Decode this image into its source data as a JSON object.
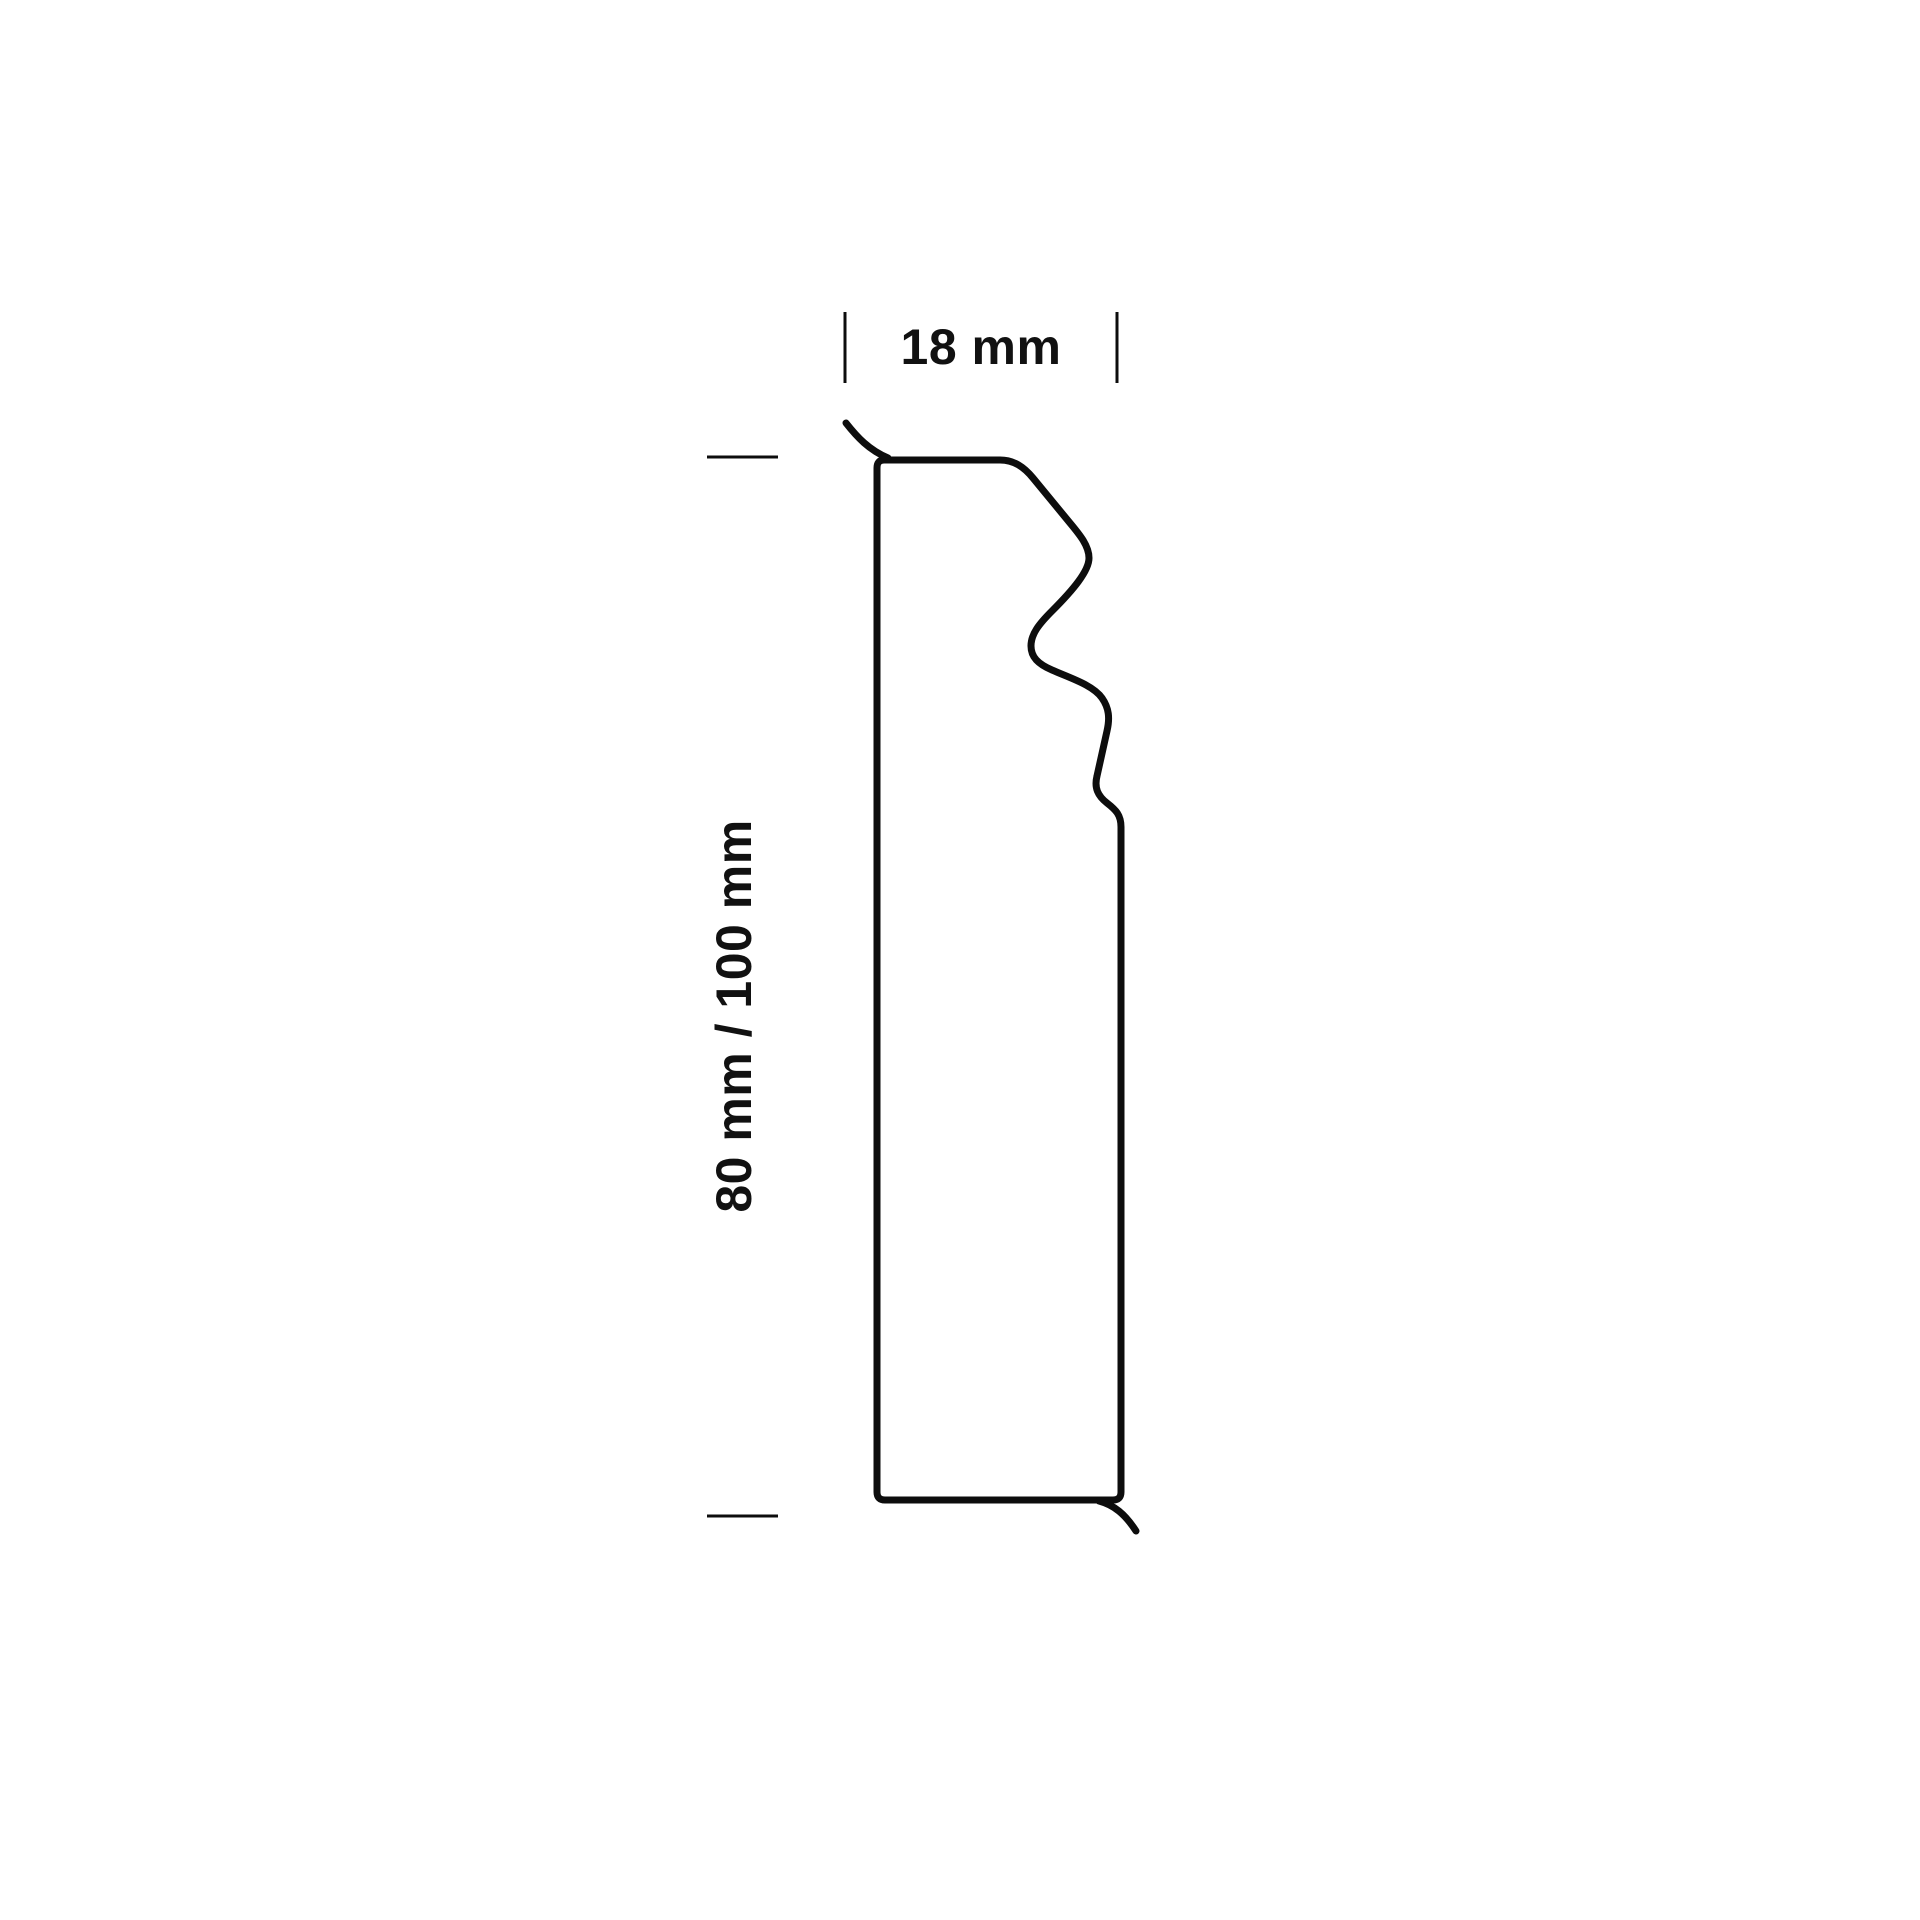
{
  "diagram": {
    "type": "skirting-board profile cross-section",
    "width_label": "18 mm",
    "height_label": "80 mm / 100 mm",
    "width_mm": 18,
    "height_mm_options": [
      80,
      100
    ]
  },
  "colors": {
    "background": "#ffffff",
    "line": "#0d0d0d",
    "text": "#111111"
  }
}
